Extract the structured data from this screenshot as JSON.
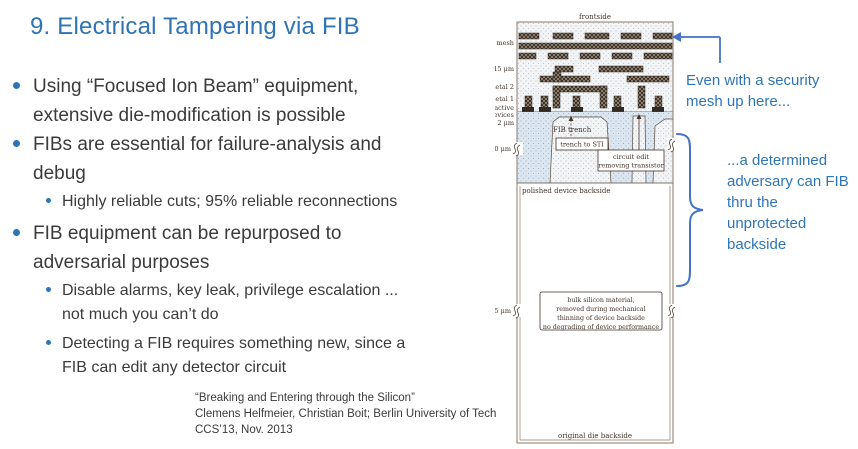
{
  "slide": {
    "title": "9. Electrical Tampering via FIB",
    "bullets": [
      {
        "level": 1,
        "text": "Using “Focused Ion Beam” equipment,\nextensive die-modification is possible"
      },
      {
        "level": 1,
        "text": "FIBs are essential for failure-analysis and\ndebug"
      },
      {
        "level": 2,
        "text": "Highly reliable cuts; 95% reliable reconnections"
      },
      {
        "level": 1,
        "text": "FIB equipment can be repurposed to\nadversarial purposes"
      },
      {
        "level": 2,
        "text": "Disable alarms, key leak, privilege escalation ...\nnot much you can’t do"
      },
      {
        "level": 2,
        "text": "Detecting a FIB requires something new, since a\nFIB can edit any detector circuit"
      }
    ],
    "citation": {
      "line1": "“Breaking and Entering through the Silicon”",
      "line2": "Clemens Helfmeier, Christian Boit; Berlin University of Tech",
      "line3": "CCS’13, Nov. 2013"
    }
  },
  "annotations": {
    "mesh_note": "Even with a security\nmesh up here...",
    "backside_note": "...a determined\nadversary can FIB\nthru the\nunprotected\nbackside"
  },
  "diagram": {
    "labels": {
      "frontside": "frontside",
      "mesh": "mesh",
      "dim_15um": "15 μm",
      "metal2": "metal 2",
      "metal1": "metal 1",
      "active1": "active",
      "active2": "devices",
      "dim_2um": "2 μm",
      "dim_30um": "30 μm",
      "dim_315um": "315 μm",
      "fib_trench": "FIB trench",
      "trench_to_sti": "trench to STI",
      "circuit_edit_1": "circuit edit",
      "circuit_edit_2": "removing transistor",
      "polished_backside": "polished device backside",
      "bulk_note_1": "bulk silicon material,",
      "bulk_note_2": "removed during mechanical",
      "bulk_note_3": "thinning of device backside",
      "bulk_note_4": "no degrading of device performance",
      "original_backside": "original die backside"
    }
  },
  "colors": {
    "title_blue": "#2E74B5",
    "annotation_blue": "#2E75B6",
    "arrow_blue": "#4472C4",
    "body_text": "#3B3B3B",
    "diagram_ink": "#43332a",
    "silicon_fill": "#dce6f0"
  }
}
